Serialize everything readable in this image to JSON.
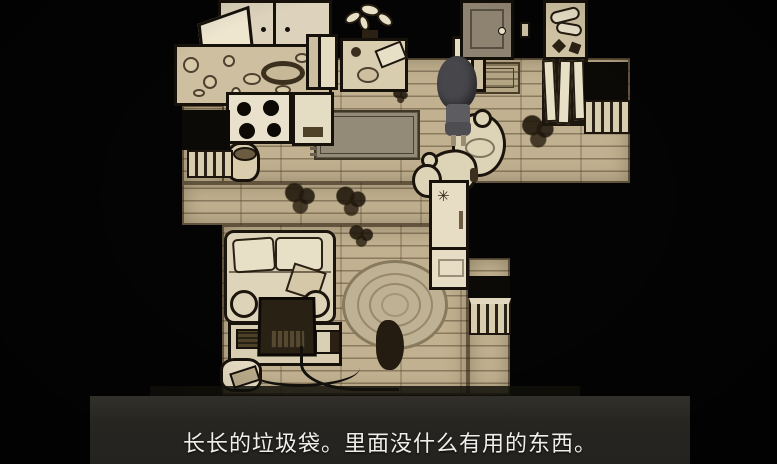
{
  "subtitle": {
    "text": "长长的垃圾袋。里面没什么有用的东西。"
  },
  "fridge": {
    "glyph": "✳"
  },
  "palette": {
    "background": "#050404",
    "floor": "#c9ba99",
    "outline": "#17110b",
    "furniture_light": "#e3d9c0",
    "furniture_dark": "#241c11",
    "door": "#8e8371",
    "character_hair": "#47464b",
    "panel": "#262520",
    "subtitle_text": "#efeeec"
  },
  "scene": {
    "objects": [
      "kitchen-cabinet",
      "dish-counter",
      "stove",
      "kitchen-bin",
      "dining-table",
      "plant",
      "chair-left",
      "chair-right",
      "front-door",
      "light-switch",
      "doormat",
      "hall-rug",
      "wall-shelf",
      "coat-rack",
      "side-table-left",
      "radiator-left",
      "side-table-right",
      "radiator-right",
      "garbage-bags",
      "refrigerator",
      "sofa",
      "tv",
      "tv-desk",
      "telephone",
      "round-rug",
      "radiator-corridor",
      "player-character",
      "debris"
    ]
  }
}
